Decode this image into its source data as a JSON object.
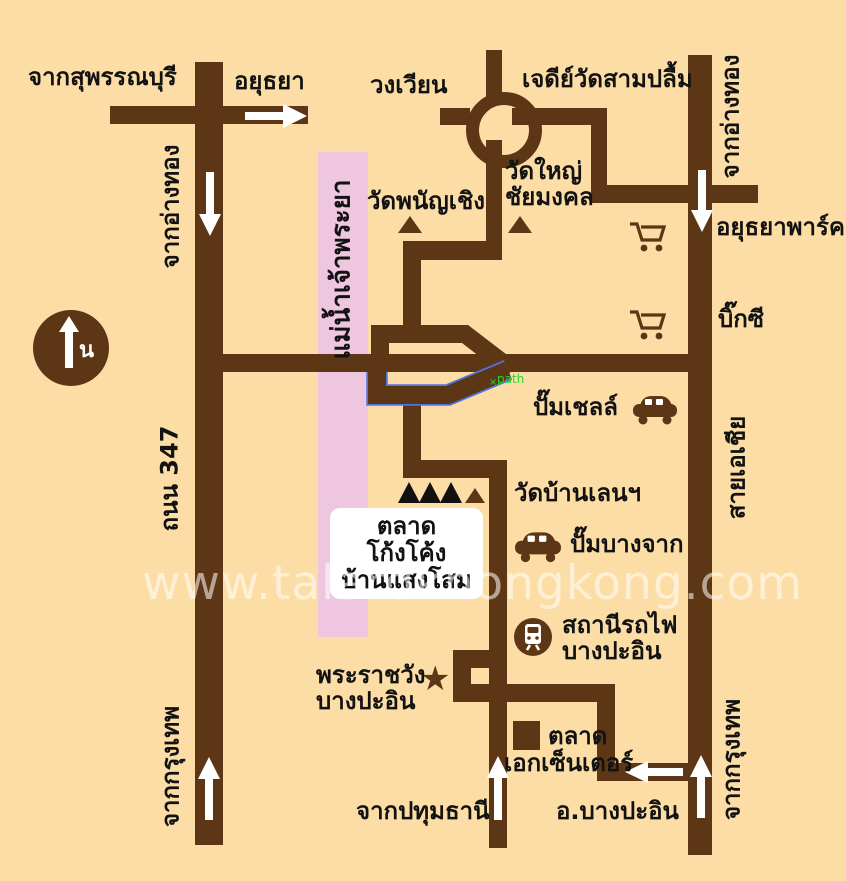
{
  "colors": {
    "background": "#fcdda6",
    "road": "#5d3616",
    "river": "#efc6e0",
    "ink": "#121212",
    "white": "#ffffff",
    "selection": "#4f74e3",
    "path_green": "#2ed52e",
    "marker_black": "#111111"
  },
  "compass": {
    "north_label": "น"
  },
  "watermark": {
    "text": "www.talardkhongkong.com"
  },
  "destination_box": {
    "line1": "ตลาดโก้งโค้ง",
    "line2": "บ้านแสงโสม"
  },
  "icons": {
    "star": "★",
    "selection_x": "×"
  },
  "labels": {
    "from_suphanburi": "จากสุพรรณบุรี",
    "ayutthaya": "อยุธยา",
    "roundabout": "วงเวียน",
    "chedi_wat_sam_pluem": "เจดีย์วัดสามปลื้ม",
    "from_angthong_left": "จากอ่างทอง",
    "from_angthong_right": "จากอ่างทอง",
    "wat_phanan_choeng": "วัดพนัญเชิง",
    "wat_yai_line1": "วัดใหญ่",
    "wat_yai_line2": "ชัยมงคล",
    "ayutthaya_park": "อยุธยาพาร์ค",
    "big_c": "บิ๊กซี",
    "river": "แม่น้ำเจ้าพระยา",
    "shell_station": "ปั๊มเชลล์",
    "road_347": "ถนน 347",
    "asia_highway": "สายเอเชีย",
    "wat_ban_len": "วัดบ้านเลนฯ",
    "bangchak_station": "ปั๊มบางจาก",
    "train_station_line1": "สถานีรถไฟ",
    "train_station_line2": "บางปะอิน",
    "palace_line1": "พระราชวัง",
    "palace_line2": "บางปะอิน",
    "market": "ตลาด",
    "ek_center": "เอกเซ็นเตอร์",
    "from_pathum_thani": "จากปทุมธานี",
    "bang_pa_in_district": "อ.บางปะอิน",
    "from_bangkok_left": "จากกรุงเทพ",
    "from_bangkok_right": "จากกรุงเทพ",
    "path_annotation": "path"
  }
}
